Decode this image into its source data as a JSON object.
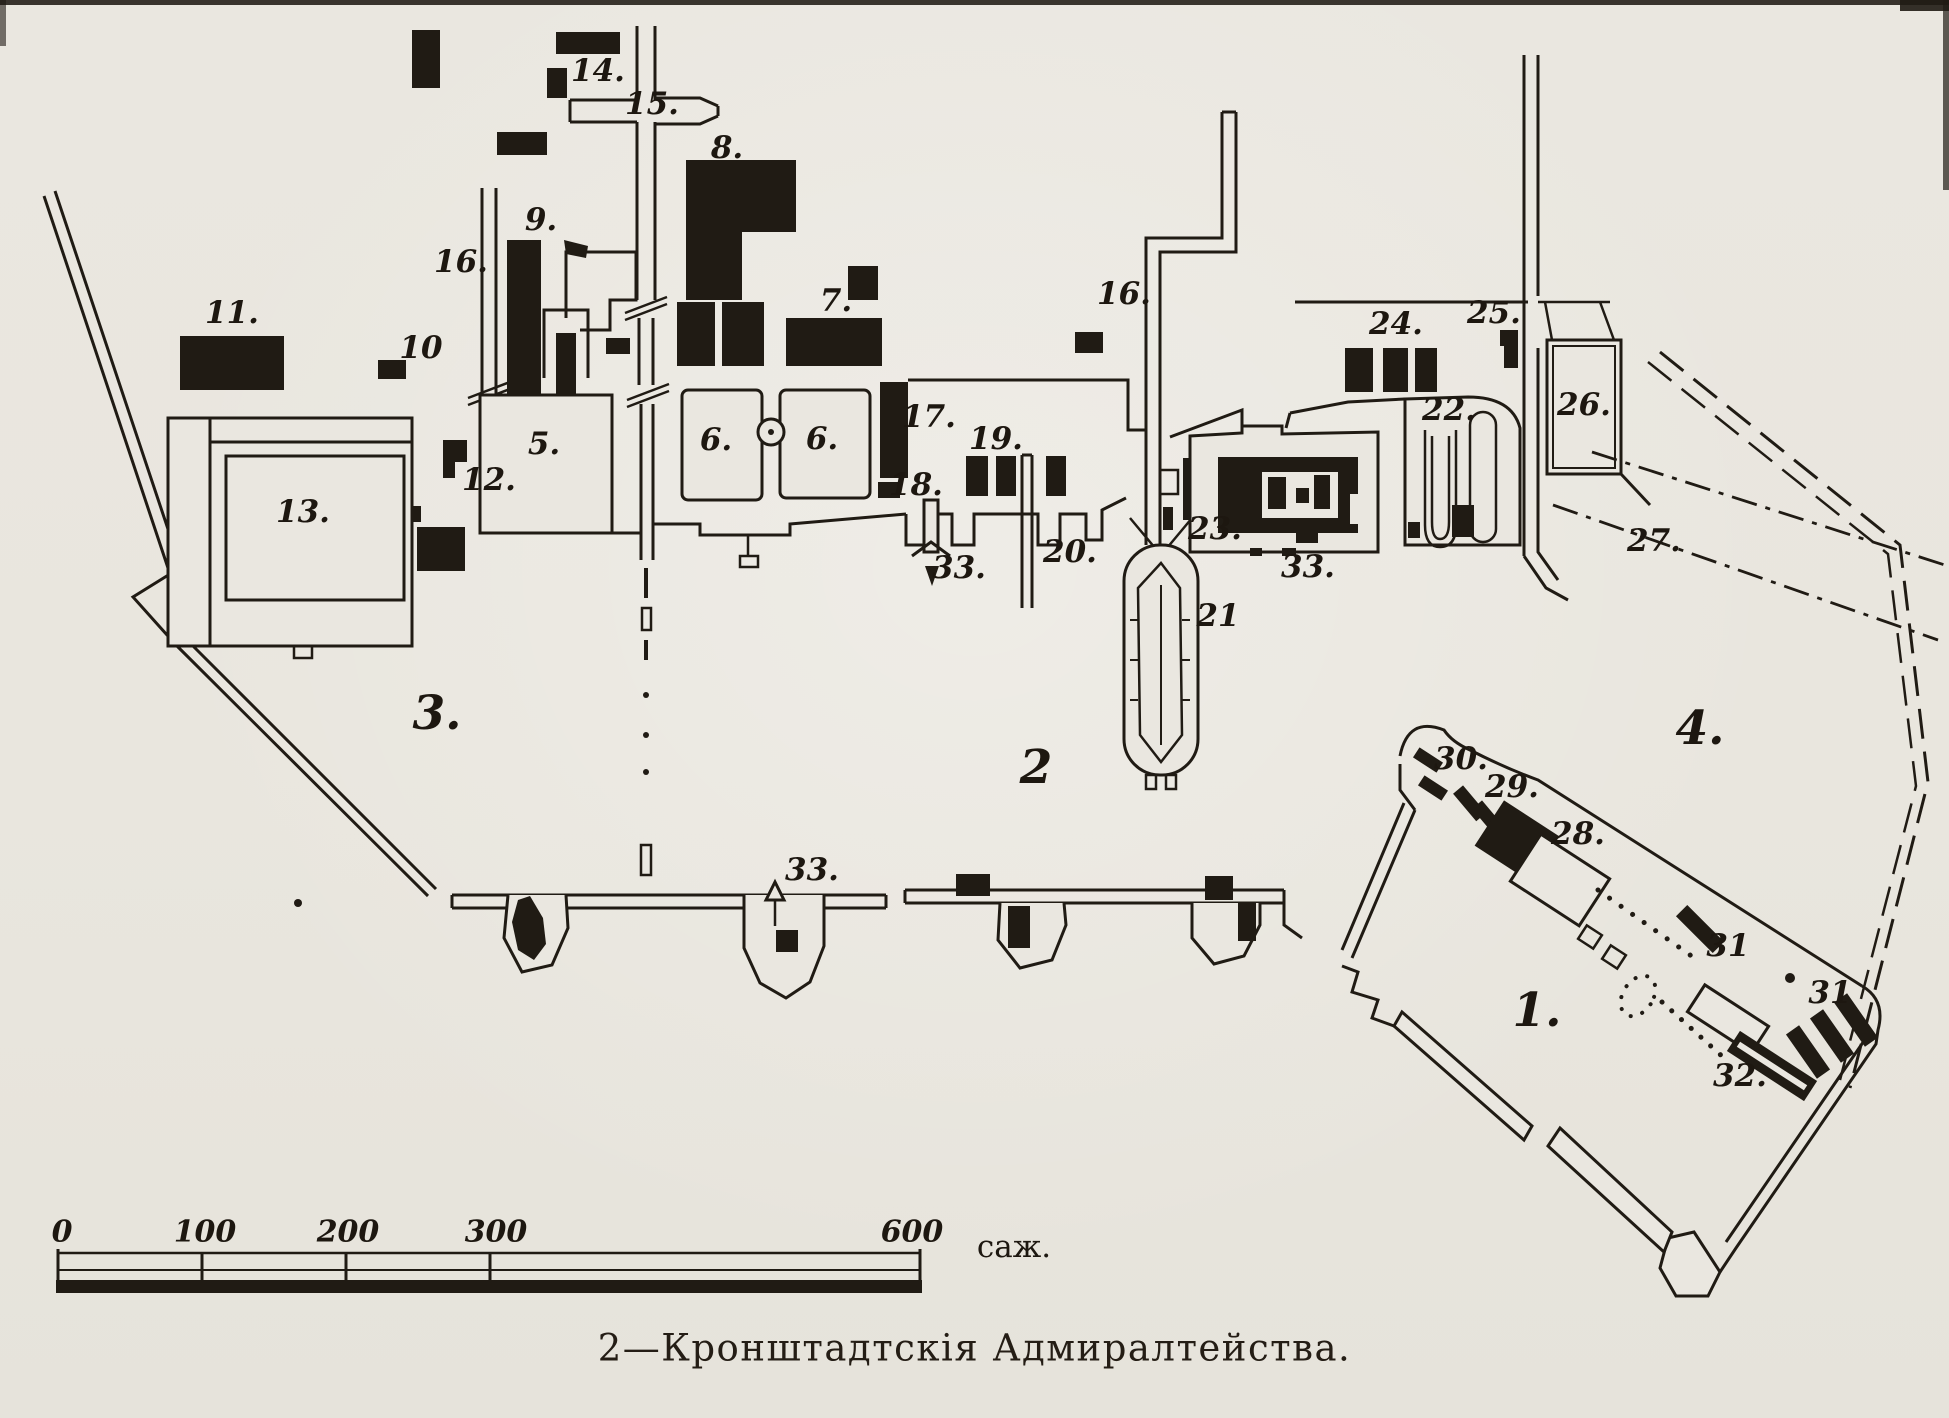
{
  "palette": {
    "paper": "#eae7e0",
    "ink": "#201b14"
  },
  "caption": "2—Кронштадтскія Адмиралтейства.",
  "scale_bar": {
    "unit": "саж.",
    "unit_x": 1014,
    "unit_y": 1249,
    "labels_y": 1234,
    "ticks": [
      {
        "label": "0",
        "x": 62
      },
      {
        "label": "100",
        "x": 205
      },
      {
        "label": "200",
        "x": 348
      },
      {
        "label": "300",
        "x": 496
      },
      {
        "label": "600",
        "x": 912
      }
    ]
  },
  "map_labels": {
    "regions": [
      {
        "text": "1.",
        "x": 1537,
        "y": 1013
      },
      {
        "text": "2",
        "x": 1036,
        "y": 770
      },
      {
        "text": "3.",
        "x": 437,
        "y": 716
      },
      {
        "text": "4.",
        "x": 1700,
        "y": 731
      }
    ],
    "numbers": [
      {
        "text": "14.",
        "x": 598,
        "y": 73
      },
      {
        "text": "15.",
        "x": 652,
        "y": 106
      },
      {
        "text": "8.",
        "x": 727,
        "y": 150
      },
      {
        "text": "9.",
        "x": 541,
        "y": 222
      },
      {
        "text": "16.",
        "x": 461,
        "y": 264
      },
      {
        "text": "10",
        "x": 421,
        "y": 350
      },
      {
        "text": "11.",
        "x": 232,
        "y": 315
      },
      {
        "text": "13.",
        "x": 303,
        "y": 514
      },
      {
        "text": "12.",
        "x": 489,
        "y": 482
      },
      {
        "text": "5.",
        "x": 544,
        "y": 446
      },
      {
        "text": "6.",
        "x": 716,
        "y": 442
      },
      {
        "text": "6.",
        "x": 822,
        "y": 441
      },
      {
        "text": "7.",
        "x": 836,
        "y": 303
      },
      {
        "text": "17.",
        "x": 929,
        "y": 419
      },
      {
        "text": "18.",
        "x": 916,
        "y": 487
      },
      {
        "text": "19.",
        "x": 996,
        "y": 441
      },
      {
        "text": "20.",
        "x": 1070,
        "y": 554
      },
      {
        "text": "33.",
        "x": 959,
        "y": 570
      },
      {
        "text": "21",
        "x": 1218,
        "y": 618
      },
      {
        "text": "16.",
        "x": 1124,
        "y": 296
      },
      {
        "text": "23.",
        "x": 1215,
        "y": 531
      },
      {
        "text": "33.",
        "x": 1308,
        "y": 569
      },
      {
        "text": "24.",
        "x": 1396,
        "y": 326
      },
      {
        "text": "25.",
        "x": 1494,
        "y": 315
      },
      {
        "text": "22.",
        "x": 1449,
        "y": 412
      },
      {
        "text": "26.",
        "x": 1584,
        "y": 407
      },
      {
        "text": "27.",
        "x": 1654,
        "y": 543
      },
      {
        "text": "30.",
        "x": 1461,
        "y": 761
      },
      {
        "text": "29.",
        "x": 1512,
        "y": 789
      },
      {
        "text": "28.",
        "x": 1578,
        "y": 836
      },
      {
        "text": "31",
        "x": 1728,
        "y": 948
      },
      {
        "text": "31",
        "x": 1830,
        "y": 995
      },
      {
        "text": "32.",
        "x": 1740,
        "y": 1078
      },
      {
        "text": "33.",
        "x": 812,
        "y": 872
      }
    ]
  }
}
